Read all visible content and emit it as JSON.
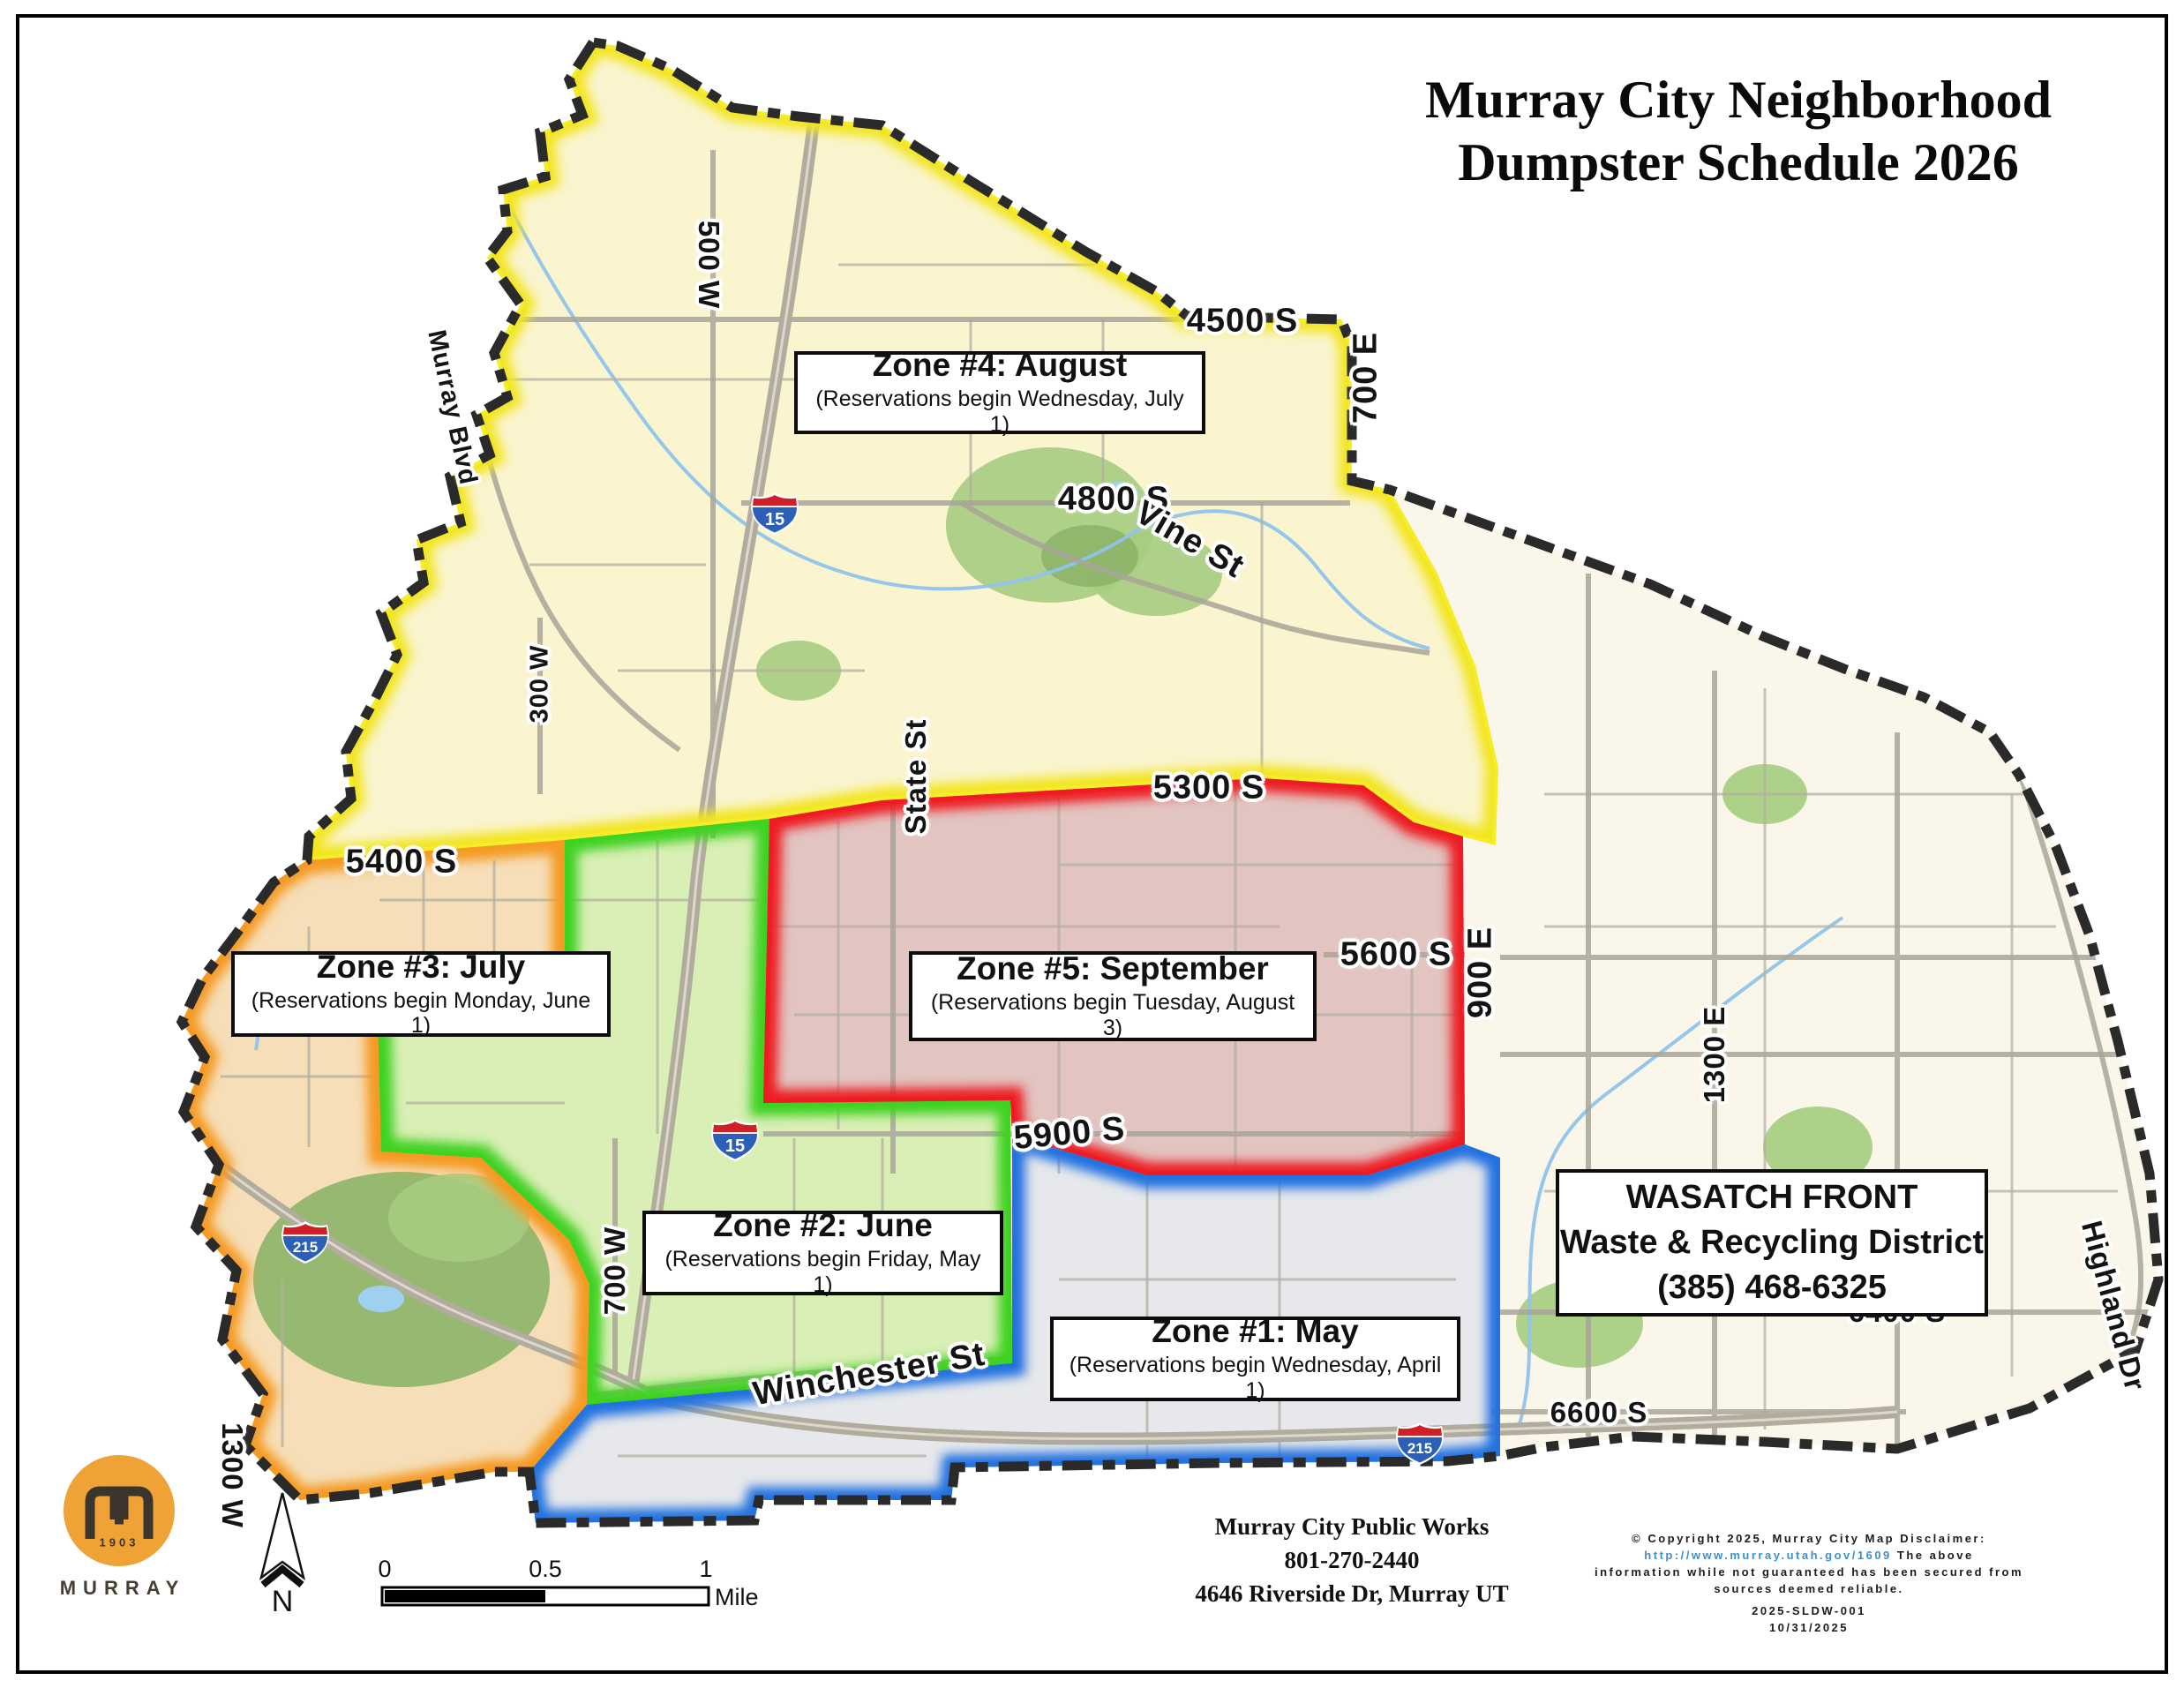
{
  "page": {
    "title_line1": "Murray City Neighborhood",
    "title_line2": "Dumpster Schedule 2026"
  },
  "zones": [
    {
      "name": "Zone 1",
      "title": "Zone #1: May",
      "subtitle": "(Reservations begin Wednesday, April 1)",
      "border_color": "#2472e0",
      "fill_color": "#e7e8eb"
    },
    {
      "name": "Zone 2",
      "title": "Zone #2: June",
      "subtitle": "(Reservations begin Friday, May 1)",
      "border_color": "#3fd223",
      "fill_color": "#d9efb5"
    },
    {
      "name": "Zone 3",
      "title": "Zone #3: July",
      "subtitle": "(Reservations begin Monday, June 1)",
      "border_color": "#f59a23",
      "fill_color": "#f6deb8"
    },
    {
      "name": "Zone 4",
      "title": "Zone #4: August",
      "subtitle": "(Reservations begin Wednesday, July 1)",
      "border_color": "#f2e51e",
      "fill_color": "#faf4cf"
    },
    {
      "name": "Zone 5",
      "title": "Zone #5: September",
      "subtitle": "(Reservations begin Tuesday, August 3)",
      "border_color": "#ed1c24",
      "fill_color": "#e2c4c0"
    }
  ],
  "info_box": {
    "line1": "WASATCH FRONT",
    "line2": "Waste & Recycling District",
    "line3": "(385) 468-6325"
  },
  "streets": {
    "s4500": "4500 S",
    "e700": "700 E",
    "w500": "500 W",
    "murray_blvd": "Murray Blvd",
    "s4800": "4800 S",
    "vine": "Vine St",
    "s5300": "5300 S",
    "s5400": "5400 S",
    "state": "State St",
    "s5600": "5600 S",
    "e900": "900 E",
    "w300": "300 W",
    "s5900": "5900 S",
    "w700": "700 W",
    "e1300": "1300 E",
    "highland": "Highland Dr",
    "winchester": "Winchester St",
    "s6400": "6400 S",
    "s6600": "6600 S",
    "w1300": "1300 W"
  },
  "shields": {
    "i15": "15",
    "i215": "215"
  },
  "scale_bar": {
    "t0": "0",
    "t05": "0.5",
    "t1": "1",
    "unit": "Mile"
  },
  "north_label": "N",
  "logo": {
    "year": "1903",
    "name": "MURRAY"
  },
  "public_works": {
    "line1": "Murray City Public Works",
    "line2": "801-270-2440",
    "line3": "4646 Riverside Dr, Murray UT"
  },
  "disclaimer": {
    "line1": "© Copyright 2025, Murray City Map Disclaimer:",
    "url": "http://www.murray.utah.gov/1609",
    "after_url": "The above",
    "line3": "information while not guaranteed has been secured from",
    "line4": "sources deemed reliable.",
    "code": "2025-SLDW-001",
    "date": "10/31/2025"
  },
  "map_colors": {
    "city_outline": "#2a2a2a",
    "unzoned_fill": "#faf7ea",
    "road": "#b3afa2",
    "water": "#8fc3ec",
    "park": "#a5cc80"
  }
}
